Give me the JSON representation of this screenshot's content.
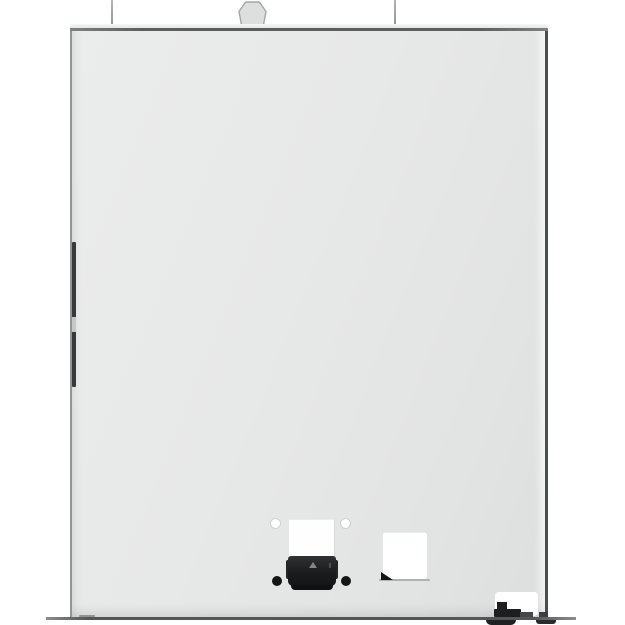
{
  "image": {
    "type": "product-photo",
    "subject": "rear panel of a light gray appliance"
  },
  "colors": {
    "background": "#ffffff",
    "panel_face_light": "#ebecec",
    "panel_face_dark": "#dddede",
    "panel_top_edge": "#5b5e5f",
    "panel_left_edge": "#929495",
    "panel_right_edge": "#4b4e4f",
    "hinge_strip": "#37393a",
    "knob_fill": "#dddede",
    "knob_stroke": "#a3a5a6",
    "connector_black": "#1d1f20",
    "cutout_white": "#fefefe",
    "screw_black": "#131515",
    "base_line": "#535556",
    "foot_dark": "#1f2122"
  },
  "parts": {
    "pin_left": "thin mounting pin at top left",
    "pin_right": "thin mounting pin at top right",
    "knob": "hexagonal knob at top center",
    "panel": "large light gray rear panel",
    "hinge": "dark hinge strip on left edge",
    "hole_tl": "white screw hole left",
    "hole_tr": "white screw hole right",
    "cable_cutout": "white rectangular cord cutout",
    "connector": "black power cord connector",
    "screw_bl": "black screw lower left",
    "screw_br": "black screw lower right",
    "vent": "square vent cutout",
    "tri_mark": "black alignment triangle",
    "corner_cutout": "rounded corner cutout",
    "bracket": "black corner bracket",
    "base_line": "base edge line",
    "feet": "dark feet under base"
  }
}
